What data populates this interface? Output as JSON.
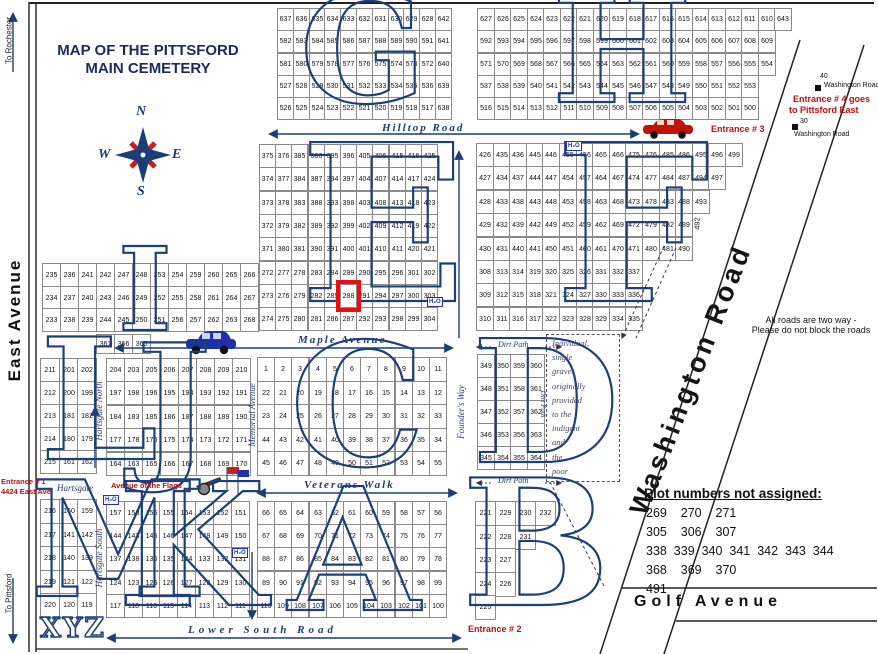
{
  "header": {
    "title_line1": "MAP OF THE PITTSFORD",
    "title_line2": "MAIN CEMETERY"
  },
  "compass": {
    "n": "N",
    "e": "E",
    "s": "S",
    "w": "W"
  },
  "edges": {
    "east_avenue": "East Avenue",
    "to_rochester": "To Rochester",
    "to_pittsford": "To Pittsford"
  },
  "roads": {
    "hilltop": "Hilltop Road",
    "maple": "Maple Avenue",
    "veterans": "Veterans Walk",
    "lower_south": "Lower South Road",
    "golf": "Golf Avenue",
    "washington": "Washington Road",
    "memorial": "Memorial Avenue",
    "founders": "Founder's Way",
    "hartsgate_north": "Hartsgate North",
    "hartsgate_south": "Hartsgate South",
    "hartsgate": "Hartsgate",
    "dirt_path_top": "Dirt Path",
    "dirt_path_bottom": "Dirt Path",
    "dirt_path_vertical": "Dirt Path",
    "avenue_of_flags": "Avenue of the Flags"
  },
  "entrances": {
    "e1_line1": "Entrance # 1",
    "e1_line2": "4424 East Ave",
    "e2": "Entrance # 2",
    "e3": "Entrance # 3",
    "e4_line1": "Entrance # 4 goes",
    "e4_line2": "to Pittsford East"
  },
  "notes": {
    "two_way_line1": "All roads are two way -",
    "two_way_line2": "Please do not block the roads",
    "indigent_lines": [
      "Individual,",
      "single",
      "graves",
      "originally",
      "provided",
      "to the",
      "indigent",
      "and",
      "the",
      "poor"
    ]
  },
  "unassigned": {
    "title": "Plot numbers not assigned:",
    "rows": [
      [
        269,
        270,
        271
      ],
      [
        305,
        306,
        307
      ],
      [
        338,
        339,
        340,
        341,
        342,
        343,
        344
      ],
      [
        368,
        369,
        370
      ],
      [
        491
      ]
    ]
  },
  "markers": {
    "h2o": {
      "label": "H₂O",
      "positions": [
        [
          566,
          141
        ],
        [
          427,
          297
        ],
        [
          103,
          495
        ],
        [
          232,
          548
        ]
      ]
    },
    "wash_top": {
      "number": "40",
      "label": "Washington Road"
    },
    "wash_bottom": {
      "number": "30",
      "label": "Washington Road"
    }
  },
  "highlight": {
    "section": "E",
    "plot": "288"
  },
  "xyz": "XYZ",
  "f_extra": {
    "rotated_plot": "492"
  },
  "colors": {
    "accent_navy": "#1c3e78",
    "entrance_red": "#c01010",
    "highlight_red": "#ec0d0d"
  },
  "sections": [
    {
      "id": "G",
      "letter": "G",
      "x": 277,
      "y": 8,
      "cw": 15.8,
      "rh": 22.3,
      "lx": 300,
      "ly": -24,
      "ls": 148,
      "rows": [
        [
          637,
          636,
          635,
          634,
          633,
          632,
          631,
          630,
          629,
          628,
          642
        ],
        [
          582,
          583,
          584,
          585,
          586,
          587,
          588,
          589,
          590,
          591,
          641
        ],
        [
          581,
          580,
          579,
          578,
          577,
          576,
          575,
          574,
          573,
          572,
          640
        ],
        [
          527,
          528,
          529,
          530,
          531,
          532,
          533,
          534,
          535,
          536,
          639
        ],
        [
          526,
          525,
          524,
          523,
          522,
          521,
          520,
          519,
          518,
          517,
          638
        ]
      ]
    },
    {
      "id": "H",
      "letter": "H",
      "x": 477,
      "y": 8,
      "cw": 16.5,
      "rh": 22.3,
      "lx": 552,
      "ly": -24,
      "ls": 148,
      "rows": [
        [
          627,
          626,
          625,
          624,
          623,
          622,
          621,
          620,
          619,
          618,
          617,
          616,
          615,
          614,
          613,
          612,
          611,
          610,
          643
        ],
        [
          592,
          593,
          594,
          595,
          596,
          597,
          598,
          599,
          600,
          601,
          602,
          603,
          604,
          605,
          606,
          607,
          608,
          609
        ],
        [
          571,
          570,
          569,
          568,
          567,
          566,
          565,
          564,
          563,
          562,
          561,
          560,
          559,
          558,
          557,
          556,
          555,
          554
        ],
        [
          537,
          538,
          539,
          540,
          541,
          542,
          543,
          544,
          545,
          546,
          547,
          548,
          549,
          550,
          551,
          552,
          553
        ],
        [
          516,
          515,
          514,
          513,
          512,
          511,
          510,
          509,
          508,
          507,
          506,
          505,
          504,
          503,
          502,
          501,
          500
        ]
      ]
    },
    {
      "id": "E",
      "letter": "E",
      "x": 259,
      "y": 144,
      "cw": 16.2,
      "rh": 23.3,
      "lx": 300,
      "ly": 116,
      "ls": 218,
      "rows": [
        [
          375,
          376,
          385,
          386,
          395,
          396,
          405,
          406,
          415,
          416,
          425
        ],
        [
          374,
          377,
          384,
          387,
          394,
          397,
          404,
          407,
          414,
          417,
          424
        ],
        [
          373,
          378,
          383,
          388,
          393,
          398,
          403,
          408,
          413,
          418,
          423
        ],
        [
          372,
          379,
          382,
          389,
          392,
          399,
          402,
          409,
          412,
          419,
          422
        ],
        [
          371,
          380,
          381,
          390,
          391,
          400,
          401,
          410,
          411,
          420,
          421
        ],
        [
          272,
          277,
          278,
          283,
          284,
          289,
          290,
          295,
          296,
          301,
          302
        ],
        [
          273,
          276,
          279,
          282,
          285,
          288,
          291,
          294,
          297,
          300,
          303
        ],
        [
          274,
          275,
          280,
          281,
          286,
          287,
          292,
          293,
          298,
          299,
          304
        ]
      ]
    },
    {
      "id": "F",
      "letter": "F",
      "x": 476,
      "y": 143,
      "cw": 16.6,
      "rh": 23.4,
      "lx": 555,
      "ly": 116,
      "ls": 218,
      "rows": [
        [
          426,
          435,
          436,
          445,
          446,
          455,
          456,
          465,
          466,
          475,
          476,
          485,
          486,
          495,
          496,
          499
        ],
        [
          427,
          434,
          437,
          444,
          447,
          454,
          457,
          464,
          467,
          474,
          477,
          484,
          487,
          494,
          497
        ],
        [
          428,
          433,
          438,
          443,
          448,
          453,
          458,
          463,
          468,
          473,
          478,
          483,
          488,
          493
        ],
        [
          429,
          432,
          439,
          442,
          449,
          452,
          459,
          462,
          469,
          472,
          479,
          482,
          489
        ],
        [
          430,
          431,
          440,
          441,
          450,
          451,
          460,
          461,
          470,
          471,
          480,
          481,
          490
        ],
        [
          308,
          313,
          314,
          319,
          320,
          325,
          326,
          331,
          332,
          337
        ],
        [
          309,
          312,
          315,
          318,
          321,
          324,
          327,
          330,
          333,
          336
        ],
        [
          310,
          311,
          316,
          317,
          322,
          323,
          328,
          329,
          334,
          335
        ]
      ]
    },
    {
      "id": "I",
      "letter": "I",
      "x": 42,
      "y": 263,
      "cw": 18,
      "rh": 22.7,
      "lx": 118,
      "ly": 233,
      "ls": 115,
      "rows": [
        [
          235,
          236,
          241,
          242,
          247,
          248,
          253,
          254,
          259,
          260,
          265,
          266
        ],
        [
          234,
          237,
          240,
          243,
          246,
          249,
          252,
          255,
          258,
          261,
          264,
          267
        ],
        [
          233,
          238,
          239,
          244,
          245,
          250,
          251,
          256,
          257,
          262,
          263,
          268
        ]
      ]
    },
    {
      "id": "W367",
      "letter": "",
      "x": 96,
      "y": 334,
      "cw": 18,
      "rh": 19,
      "lx": 0,
      "ly": 0,
      "ls": 0,
      "rows": [
        [
          367,
          366,
          365
        ]
      ]
    },
    {
      "id": "J",
      "letter": "J",
      "x": 106,
      "y": 358,
      "cw": 18,
      "rh": 23.4,
      "lx": 136,
      "ly": 323,
      "ls": 160,
      "rows": [
        [
          204,
          203,
          205,
          206,
          207,
          208,
          209,
          210
        ],
        [
          197,
          198,
          196,
          195,
          194,
          193,
          192,
          191
        ],
        [
          184,
          183,
          185,
          186,
          187,
          188,
          189,
          190
        ],
        [
          177,
          178,
          176,
          175,
          174,
          173,
          172,
          171
        ],
        [
          164,
          163,
          165,
          166,
          167,
          168,
          169,
          170
        ]
      ]
    },
    {
      "id": "K",
      "letter": "K",
      "x": 106,
      "y": 501,
      "cw": 17.8,
      "rh": 23.2,
      "lx": 118,
      "ly": 461,
      "ls": 170,
      "rows": [
        [
          157,
          158,
          156,
          155,
          154,
          153,
          152,
          151
        ],
        [
          144,
          143,
          145,
          146,
          147,
          148,
          149,
          150
        ],
        [
          137,
          138,
          136,
          135,
          134,
          133,
          132,
          131
        ],
        [
          124,
          123,
          125,
          126,
          127,
          128,
          129,
          130
        ],
        [
          117,
          118,
          116,
          115,
          114,
          113,
          112,
          111
        ]
      ]
    },
    {
      "id": "L",
      "letter": "L",
      "x": 40,
      "y": 358,
      "cw": 18.5,
      "rh": 23,
      "lx": 40,
      "ly": 316,
      "ls": 168,
      "rows": [
        [
          211,
          201,
          202
        ],
        [
          212,
          200,
          199
        ],
        [
          213,
          181,
          182
        ],
        [
          214,
          180,
          179
        ],
        [
          215,
          161,
          162
        ]
      ]
    },
    {
      "id": "M",
      "letter": "M",
      "x": 40,
      "y": 499,
      "cw": 18.5,
      "rh": 23.5,
      "lx": 30,
      "ly": 460,
      "ls": 160,
      "rows": [
        [
          216,
          160,
          159
        ],
        [
          217,
          141,
          142
        ],
        [
          218,
          140,
          139
        ],
        [
          219,
          121,
          122
        ],
        [
          220,
          120,
          119
        ]
      ]
    },
    {
      "id": "C",
      "letter": "C",
      "x": 257,
      "y": 357,
      "cw": 17.2,
      "rh": 23.6,
      "lx": 290,
      "ly": 321,
      "ls": 170,
      "rows": [
        [
          1,
          2,
          3,
          4,
          5,
          6,
          7,
          8,
          9,
          10,
          11
        ],
        [
          22,
          21,
          20,
          19,
          18,
          17,
          16,
          15,
          14,
          13,
          12
        ],
        [
          23,
          24,
          25,
          26,
          27,
          28,
          29,
          30,
          31,
          32,
          33
        ],
        [
          44,
          43,
          42,
          41,
          40,
          39,
          38,
          37,
          36,
          35,
          34
        ],
        [
          45,
          46,
          47,
          48,
          49,
          50,
          51,
          52,
          53,
          54,
          55
        ]
      ]
    },
    {
      "id": "A",
      "letter": "A",
      "x": 257,
      "y": 501,
      "cw": 17.2,
      "rh": 23.2,
      "lx": 288,
      "ly": 466,
      "ls": 170,
      "rows": [
        [
          66,
          65,
          64,
          63,
          62,
          61,
          60,
          59,
          58,
          57,
          56
        ],
        [
          67,
          68,
          69,
          70,
          71,
          72,
          73,
          74,
          75,
          76,
          77
        ],
        [
          88,
          87,
          86,
          85,
          84,
          83,
          82,
          81,
          80,
          79,
          78
        ],
        [
          89,
          90,
          91,
          92,
          93,
          94,
          95,
          96,
          97,
          98,
          99
        ],
        [
          110,
          109,
          108,
          107,
          106,
          105,
          104,
          103,
          102,
          101,
          100
        ]
      ]
    },
    {
      "id": "D",
      "letter": "D",
      "x": 477,
      "y": 354,
      "cw": 16.6,
      "rh": 23,
      "lx": 472,
      "ly": 318,
      "ls": 170,
      "rows": [
        [
          349,
          350,
          359,
          360
        ],
        [
          348,
          351,
          358,
          361
        ],
        [
          347,
          352,
          357,
          362
        ],
        [
          346,
          353,
          356,
          363
        ],
        [
          345,
          354,
          355,
          364
        ]
      ]
    },
    {
      "id": "B",
      "letter": "B",
      "x": 475,
      "y": 501,
      "cw": 20,
      "rh": 23.5,
      "lx": 462,
      "ly": 457,
      "ls": 175,
      "rows": [
        [
          221,
          229,
          230,
          232
        ],
        [
          222,
          228,
          231
        ],
        [
          223,
          227
        ],
        [
          224,
          226
        ],
        [
          225
        ]
      ]
    }
  ]
}
